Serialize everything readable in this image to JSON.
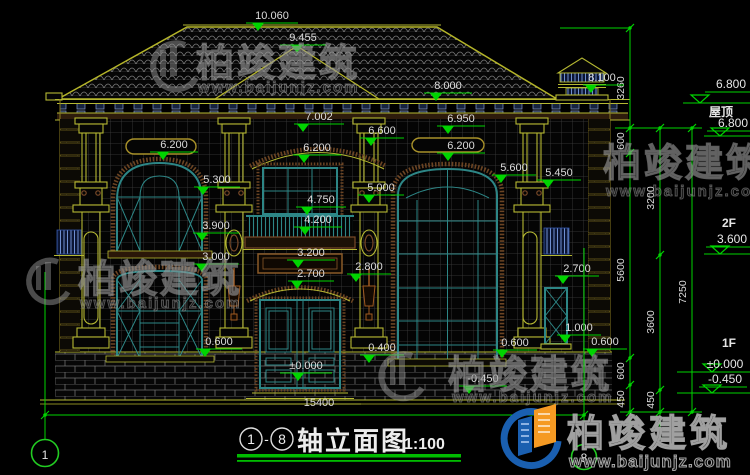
{
  "colors": {
    "cad_green": "#00d400",
    "line_yellow": "#b5b832",
    "frame_teal": "#2d8686",
    "trim_brown": "#7a4a28",
    "text_white": "#dcdcdc",
    "logo_blue": "#1a5fb0",
    "logo_orange": "#f59a23",
    "underline_green": "#00bb00"
  },
  "watermarks": {
    "brand": "柏竣建筑",
    "site": "www.baijunjz.com"
  },
  "logo": {
    "brand": "柏竣建筑",
    "site": "www.baijunjz.com"
  },
  "title_block": {
    "axis_start": "1",
    "separator": "-",
    "axis_end": "8",
    "name": "轴立面图",
    "scale": "1:100"
  },
  "axis_bubbles": {
    "left": "1",
    "right": "8"
  },
  "ground_dim": "15400",
  "drawing": {
    "elevation_labels": [
      {
        "t": "10.060",
        "x": 272,
        "y": 19,
        "lx1": 246,
        "lx2": 298,
        "ly": 23,
        "tx": 258
      },
      {
        "t": "9.455",
        "x": 303,
        "y": 41,
        "lx1": 280,
        "lx2": 326,
        "ly": 45,
        "tx": 297
      },
      {
        "t": "8.000",
        "x": 448,
        "y": 89,
        "lx1": 424,
        "lx2": 472,
        "ly": 93,
        "tx": 436
      },
      {
        "t": "8.100",
        "x": 602,
        "y": 81,
        "lx1": 583,
        "lx2": 624,
        "ly": 85,
        "tx": 591
      },
      {
        "t": "7.002",
        "x": 319,
        "y": 120,
        "lx1": 294,
        "lx2": 344,
        "ly": 124,
        "tx": 303
      },
      {
        "t": "6.950",
        "x": 461,
        "y": 122,
        "lx1": 437,
        "lx2": 485,
        "ly": 126,
        "tx": 448
      },
      {
        "t": "6.600",
        "x": 382,
        "y": 134,
        "lx1": 360,
        "lx2": 404,
        "ly": 138,
        "tx": 371
      },
      {
        "t": "6.200",
        "x": 174,
        "y": 148,
        "lx1": 150,
        "lx2": 198,
        "ly": 152,
        "tx": 163
      },
      {
        "t": "6.200",
        "x": 317,
        "y": 151,
        "lx1": 293,
        "lx2": 341,
        "ly": 155,
        "tx": 304
      },
      {
        "t": "6.200",
        "x": 461,
        "y": 149,
        "lx1": 437,
        "lx2": 485,
        "ly": 153,
        "tx": 448
      },
      {
        "t": "5.600",
        "x": 514,
        "y": 171,
        "lx1": 492,
        "lx2": 536,
        "ly": 175,
        "tx": 501
      },
      {
        "t": "5.450",
        "x": 559,
        "y": 176,
        "lx1": 537,
        "lx2": 581,
        "ly": 180,
        "tx": 548
      },
      {
        "t": "5.300",
        "x": 217,
        "y": 183,
        "lx1": 194,
        "lx2": 240,
        "ly": 187,
        "tx": 203
      },
      {
        "t": "5.000",
        "x": 381,
        "y": 191,
        "lx1": 358,
        "lx2": 404,
        "ly": 195,
        "tx": 369
      },
      {
        "t": "4.750",
        "x": 321,
        "y": 203,
        "lx1": 296,
        "lx2": 346,
        "ly": 207,
        "tx": 307
      },
      {
        "t": "4.200",
        "x": 318,
        "y": 223,
        "lx1": 294,
        "lx2": 342,
        "ly": 227,
        "tx": 305
      },
      {
        "t": "3.900",
        "x": 216,
        "y": 229,
        "lx1": 193,
        "lx2": 239,
        "ly": 233,
        "tx": 202
      },
      {
        "t": "3.200",
        "x": 311,
        "y": 256,
        "lx1": 287,
        "lx2": 335,
        "ly": 260,
        "tx": 298
      },
      {
        "t": "3.000",
        "x": 216,
        "y": 260,
        "lx1": 193,
        "lx2": 239,
        "ly": 264,
        "tx": 202
      },
      {
        "t": "2.800",
        "x": 369,
        "y": 270,
        "lx1": 347,
        "lx2": 391,
        "ly": 274,
        "tx": 356
      },
      {
        "t": "2.700",
        "x": 311,
        "y": 277,
        "lx1": 288,
        "lx2": 334,
        "ly": 281,
        "tx": 297
      },
      {
        "t": "2.700",
        "x": 577,
        "y": 272,
        "lx1": 555,
        "lx2": 599,
        "ly": 276,
        "tx": 563
      },
      {
        "t": "1.000",
        "x": 579,
        "y": 331,
        "lx1": 557,
        "lx2": 601,
        "ly": 335,
        "tx": 565
      },
      {
        "t": "0.600",
        "x": 219,
        "y": 345,
        "lx1": 196,
        "lx2": 242,
        "ly": 349,
        "tx": 205
      },
      {
        "t": "0.600",
        "x": 515,
        "y": 346,
        "lx1": 493,
        "lx2": 537,
        "ly": 350,
        "tx": 502
      },
      {
        "t": "0.600",
        "x": 605,
        "y": 345,
        "lx1": 583,
        "lx2": 627,
        "ly": 349,
        "tx": 592
      },
      {
        "t": "0.400",
        "x": 382,
        "y": 351,
        "lx1": 360,
        "lx2": 404,
        "ly": 355,
        "tx": 369
      },
      {
        "t": "±0.000",
        "x": 306,
        "y": 369,
        "lx1": 280,
        "lx2": 332,
        "ly": 373,
        "tx": 298
      },
      {
        "t": "-0.450",
        "x": 483,
        "y": 382,
        "lx1": 459,
        "lx2": 507,
        "ly": 386,
        "tx": 469
      }
    ],
    "chain_dims": [
      {
        "t": "3260",
        "x": 624,
        "y": 88
      },
      {
        "t": "600",
        "x": 624,
        "y": 141
      },
      {
        "t": "5600",
        "x": 624,
        "y": 270
      },
      {
        "t": "600",
        "x": 624,
        "y": 371
      },
      {
        "t": "450",
        "x": 624,
        "y": 399
      },
      {
        "t": "3200",
        "x": 654,
        "y": 198
      },
      {
        "t": "3600",
        "x": 654,
        "y": 322
      },
      {
        "t": "450",
        "x": 654,
        "y": 400
      },
      {
        "t": "7250",
        "x": 686,
        "y": 292
      }
    ],
    "chains": [
      {
        "x": 630,
        "y1": 28,
        "y2": 438,
        "ticks": [
          28,
          128,
          153,
          358,
          385,
          412
        ]
      },
      {
        "x": 660,
        "y1": 128,
        "y2": 438,
        "ticks": [
          128,
          255,
          390,
          412
        ]
      },
      {
        "x": 692,
        "y1": 128,
        "y2": 412,
        "ticks": [
          128,
          412
        ]
      }
    ],
    "connectors": [
      [
        560,
        28,
        630,
        28
      ],
      [
        615,
        128,
        702,
        128
      ],
      [
        620,
        412,
        702,
        412
      ]
    ],
    "levels": [
      {
        "value": "6.800",
        "name": "屋顶",
        "vx": 731,
        "vy": 88,
        "nx": 721,
        "ny": 116,
        "lx1": 683,
        "lx2": 750,
        "ly": 103,
        "tx": 700
      },
      {
        "value": "6.800",
        "vx": 733,
        "vy": 127,
        "lx1": 704,
        "lx2": 750,
        "ly": 136,
        "tx": 720
      },
      {
        "name": "2F",
        "value": "3.600",
        "nx": 729,
        "ny": 227,
        "vx": 732,
        "vy": 243,
        "lx1": 704,
        "lx2": 750,
        "ly": 254,
        "tx": 720
      },
      {
        "name": "1F",
        "nx": 729,
        "ny": 347
      },
      {
        "value": "±0.000",
        "vx": 725,
        "vy": 368,
        "lx1": 677,
        "lx2": 750,
        "ly": 372,
        "tx": 712
      },
      {
        "value": "-0.450",
        "vx": 725,
        "vy": 383,
        "lx1": 677,
        "lx2": 750,
        "ly": 393,
        "tx": 712
      }
    ]
  }
}
